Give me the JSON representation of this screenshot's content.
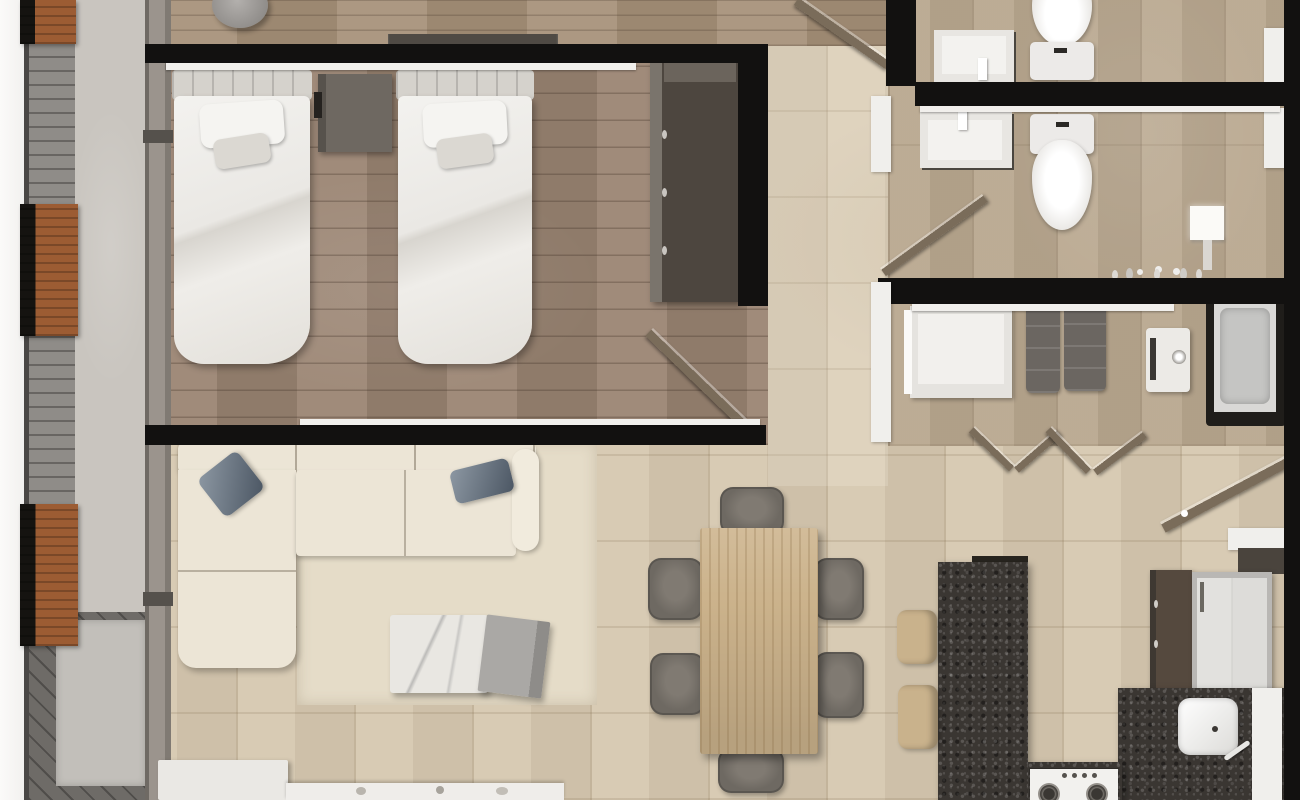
{
  "meta": {
    "type": "3d-rendered-floor-plan",
    "view": "top-down",
    "canvas": {
      "width_px": 1300,
      "height_px": 800
    }
  },
  "palette": {
    "wall_black": "#121110",
    "trim_white": "#f1efec",
    "tile_base": "#d6c8b0",
    "tile_bath": "#b9a88f",
    "wood_bedroom": "#9a8472",
    "wood_entry": "#a69078",
    "balcony_edge": "#f2f1ef",
    "balcony_slats": "#8f8c88",
    "balcony_walk": "#c9c5bf",
    "balcony_deck": "#6e6b67",
    "planter_wood": "#9c5c33",
    "planter_box": "#151310",
    "glass_band": "#9b948d",
    "sofa_cream": "#ece5d6",
    "rug_cream": "#e5dcc8",
    "pillow_blue": "#5b6673",
    "bed_white": "#ebe9e5",
    "headboard_gray": "#d5d2cc",
    "nightstand_gray": "#6e6861",
    "wardrobe_dark": "#4d463f",
    "table_wood": "#ccb38c",
    "chair_gray": "#6e6962",
    "granite_dark": "#3a3632",
    "stool_tan": "#c9b28c",
    "appliance_white": "#eceae6",
    "fixture_white": "#f0efec",
    "door_wood": "#7a6c5a"
  },
  "rooms": [
    {
      "name": "balcony",
      "furniture": [
        "planter",
        "planter",
        "planter",
        "deck-pad"
      ]
    },
    {
      "name": "bedroom",
      "furniture": [
        "twin-bed",
        "twin-bed",
        "nightstand",
        "wardrobe",
        "door"
      ]
    },
    {
      "name": "entry-hall",
      "furniture": [
        "round-stool",
        "wall-shelf",
        "entry-door"
      ]
    },
    {
      "name": "living-room",
      "furniture": [
        "l-shaped-sofa",
        "blue-pillow",
        "blue-pillow",
        "marble-coffee-table",
        "tv-bench",
        "console",
        "rug"
      ]
    },
    {
      "name": "dining-area",
      "furniture": [
        "wood-dining-table",
        "chair",
        "chair",
        "chair",
        "chair",
        "chair",
        "chair"
      ]
    },
    {
      "name": "kitchen",
      "furniture": [
        "granite-island",
        "bar-stool",
        "bar-stool",
        "tall-cabinet",
        "refrigerator",
        "counter",
        "cooktop",
        "sink"
      ]
    },
    {
      "name": "bathroom-top",
      "furniture": [
        "vanity-sink",
        "toilet"
      ]
    },
    {
      "name": "bathroom-shower",
      "furniture": [
        "vanity-sink",
        "toilet",
        "shower-fixture",
        "door"
      ]
    },
    {
      "name": "laundry-bath",
      "furniture": [
        "vanity",
        "mat",
        "mat",
        "washer",
        "bathtub",
        "bifold-doors",
        "door"
      ]
    },
    {
      "name": "hallway",
      "furniture": []
    }
  ]
}
